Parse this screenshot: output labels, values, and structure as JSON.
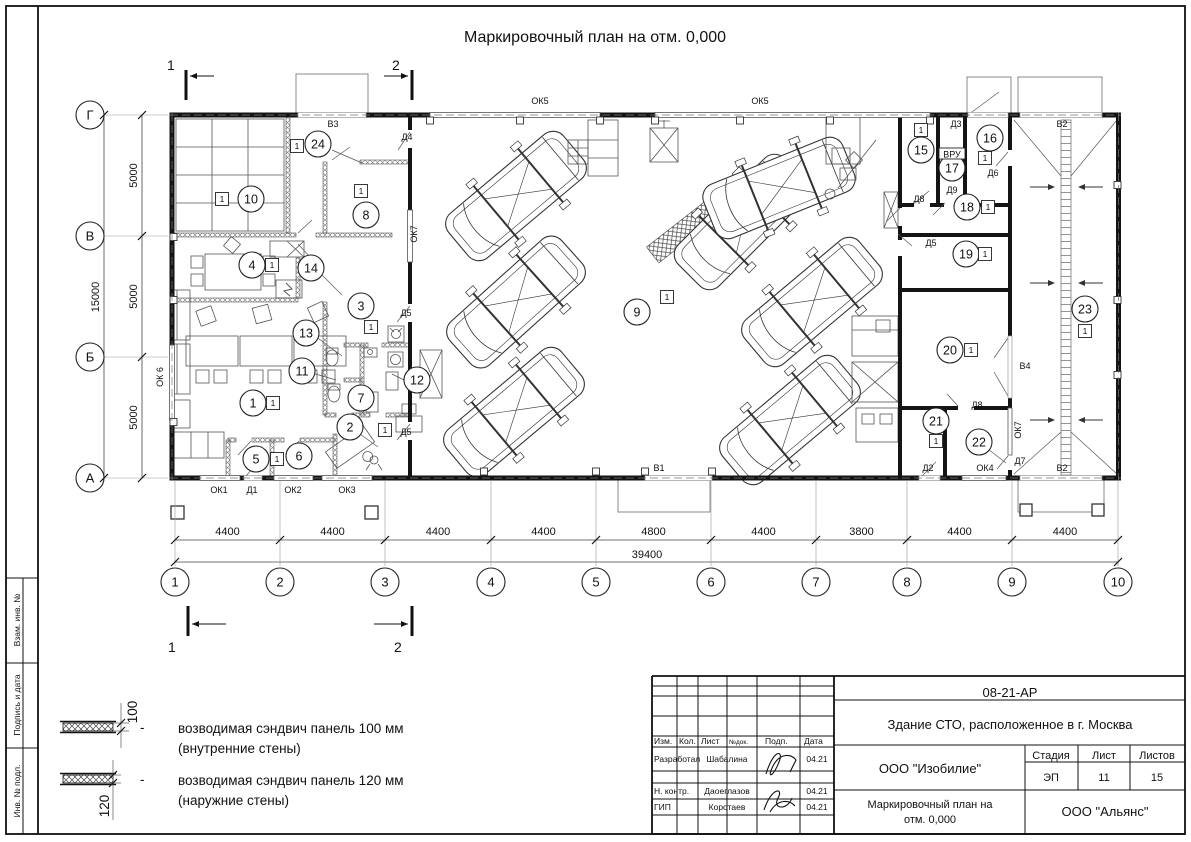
{
  "sheet": {
    "title": "Маркировочный план на отм. 0,000",
    "section_marks": [
      {
        "label": "1",
        "num_x": 167,
        "num_y": 70,
        "bar_x": 186,
        "bar_y1": 70,
        "bar_y2": 100,
        "arr_x1": 214,
        "arr_x2": 190,
        "arr_y": 76
      },
      {
        "label": "2",
        "num_x": 392,
        "num_y": 70,
        "bar_x": 412,
        "bar_y1": 70,
        "bar_y2": 100,
        "arr_x1": 384,
        "arr_x2": 408,
        "arr_y": 76
      },
      {
        "label": "1",
        "num_x": 168,
        "num_y": 652,
        "bar_x": 188,
        "bar_y1": 606,
        "bar_y2": 636,
        "arr_x1": 226,
        "arr_x2": 192,
        "arr_y": 624
      },
      {
        "label": "2",
        "num_x": 394,
        "num_y": 652,
        "bar_x": 412,
        "bar_y1": 606,
        "bar_y2": 636,
        "arr_x1": 374,
        "arr_x2": 408,
        "arr_y": 624
      }
    ]
  },
  "axes": {
    "cols": [
      {
        "n": "1",
        "x": 175
      },
      {
        "n": "2",
        "x": 280
      },
      {
        "n": "3",
        "x": 385
      },
      {
        "n": "4",
        "x": 491
      },
      {
        "n": "5",
        "x": 596
      },
      {
        "n": "6",
        "x": 711
      },
      {
        "n": "7",
        "x": 816
      },
      {
        "n": "8",
        "x": 907
      },
      {
        "n": "9",
        "x": 1012
      },
      {
        "n": "10",
        "x": 1118
      }
    ],
    "rows": [
      {
        "n": "Г",
        "y": 115
      },
      {
        "n": "В",
        "y": 236
      },
      {
        "n": "Б",
        "y": 357
      },
      {
        "n": "А",
        "y": 478
      }
    ],
    "col_dims": [
      "4400",
      "4400",
      "4400",
      "4400",
      "4800",
      "4400",
      "3800",
      "4400",
      "4400"
    ],
    "row_dims": [
      "5000",
      "5000",
      "5000"
    ],
    "total_width": "39400",
    "total_height": "15000"
  },
  "rooms": [
    {
      "n": "1",
      "x": 253,
      "y": 403,
      "sq": [
        273,
        403
      ]
    },
    {
      "n": "2",
      "x": 350,
      "y": 427,
      "sq": [
        385,
        430
      ]
    },
    {
      "n": "3",
      "x": 361,
      "y": 306,
      "sq": [
        371,
        327
      ]
    },
    {
      "n": "4",
      "x": 252,
      "y": 265,
      "sq": [
        272,
        265
      ]
    },
    {
      "n": "5",
      "x": 256,
      "y": 459,
      "sq": [
        277,
        459
      ]
    },
    {
      "n": "6",
      "x": 299,
      "y": 456
    },
    {
      "n": "7",
      "x": 361,
      "y": 398
    },
    {
      "n": "8",
      "x": 366,
      "y": 215,
      "sq": [
        361,
        191
      ]
    },
    {
      "n": "9",
      "x": 637,
      "y": 312,
      "sq": [
        667,
        297
      ]
    },
    {
      "n": "10",
      "x": 251,
      "y": 199,
      "sq": [
        222,
        199
      ]
    },
    {
      "n": "11",
      "x": 302,
      "y": 371
    },
    {
      "n": "12",
      "x": 417,
      "y": 380
    },
    {
      "n": "13",
      "x": 306,
      "y": 333
    },
    {
      "n": "14",
      "x": 311,
      "y": 268
    },
    {
      "n": "15",
      "x": 921,
      "y": 150,
      "sq": [
        921,
        130
      ]
    },
    {
      "n": "16",
      "x": 990,
      "y": 138,
      "sq": [
        985,
        158
      ]
    },
    {
      "n": "17",
      "x": 952,
      "y": 168
    },
    {
      "n": "18",
      "x": 967,
      "y": 207,
      "sq": [
        988,
        207
      ]
    },
    {
      "n": "19",
      "x": 966,
      "y": 254,
      "sq": [
        985,
        254
      ]
    },
    {
      "n": "20",
      "x": 950,
      "y": 350,
      "sq": [
        971,
        350
      ]
    },
    {
      "n": "21",
      "x": 936,
      "y": 421,
      "sq": [
        936,
        441
      ]
    },
    {
      "n": "22",
      "x": 979,
      "y": 442
    },
    {
      "n": "23",
      "x": 1085,
      "y": 309,
      "sq": [
        1085,
        331
      ]
    },
    {
      "n": "24",
      "x": 318,
      "y": 144,
      "sq": [
        297,
        146
      ]
    }
  ],
  "openings": [
    {
      "t": "ОК5",
      "x": 540,
      "y": 101
    },
    {
      "t": "ОК5",
      "x": 760,
      "y": 101
    },
    {
      "t": "В3",
      "x": 333,
      "y": 124
    },
    {
      "t": "Д4",
      "x": 407,
      "y": 137
    },
    {
      "t": "ОК7",
      "x": 414,
      "y": 234,
      "rot": -90
    },
    {
      "t": "Д5",
      "x": 406,
      "y": 313
    },
    {
      "t": "Д5",
      "x": 406,
      "y": 432
    },
    {
      "t": "ОК 6",
      "x": 160,
      "y": 377,
      "rot": -90
    },
    {
      "t": "ОК1",
      "x": 219,
      "y": 490
    },
    {
      "t": "Д1",
      "x": 252,
      "y": 490
    },
    {
      "t": "ОК2",
      "x": 293,
      "y": 490
    },
    {
      "t": "ОК3",
      "x": 347,
      "y": 490
    },
    {
      "t": "В1",
      "x": 659,
      "y": 468
    },
    {
      "t": "Д3",
      "x": 956,
      "y": 124
    },
    {
      "t": "В2",
      "x": 1062,
      "y": 124
    },
    {
      "t": "Д8",
      "x": 919,
      "y": 199
    },
    {
      "t": "ВРУ",
      "x": 952,
      "y": 156,
      "box": true
    },
    {
      "t": "Д9",
      "x": 952,
      "y": 190
    },
    {
      "t": "Д6",
      "x": 993,
      "y": 173
    },
    {
      "t": "Д5",
      "x": 931,
      "y": 243
    },
    {
      "t": "В4",
      "x": 1025,
      "y": 366
    },
    {
      "t": "Д8",
      "x": 977,
      "y": 405
    },
    {
      "t": "ОК7",
      "x": 1018,
      "y": 430,
      "rot": -90
    },
    {
      "t": "Д2",
      "x": 928,
      "y": 468
    },
    {
      "t": "ОК4",
      "x": 985,
      "y": 468
    },
    {
      "t": "Д7",
      "x": 1020,
      "y": 461
    },
    {
      "t": "В2",
      "x": 1062,
      "y": 468
    }
  ],
  "legend": {
    "items": [
      {
        "dim": "100",
        "line1": "возводимая сэндвич панель 100 мм",
        "line2": "(внутренние стены)"
      },
      {
        "dim": "120",
        "line1": "возводимая сэндвич панель 120 мм",
        "line2": "(наружние стены)"
      }
    ],
    "dash": "-"
  },
  "sidebar": [
    "Взам. инв. №",
    "Подпись и дата",
    "Инв. № подл."
  ],
  "title_block": {
    "doc_number": "08-21-АР",
    "project": "Здание СТО, расположенное в г. Москва",
    "h_izm": "Изм.",
    "h_kol": "Кол.",
    "h_list": "Лист",
    "h_ndok": "№док.",
    "h_podp": "Подп.",
    "h_data": "Дата",
    "rows": [
      {
        "role": "Разработал",
        "name": "Шабалина",
        "date": "04.21"
      },
      {
        "role": "Н. контр.",
        "name": "Даоеглазов",
        "date": "04.21"
      },
      {
        "role": "ГИП",
        "name": "Коротаев",
        "date": "04.21"
      }
    ],
    "company": "ООО \"Изобилие\"",
    "stage_label": "Стадия",
    "stage": "ЭП",
    "sheet_label": "Лист",
    "sheet": "11",
    "sheets_label": "Листов",
    "sheets": "15",
    "title_line1": "Маркировочный план на",
    "title_line2": "отм. 0,000",
    "contractor": "ООО \"Альянс\""
  }
}
